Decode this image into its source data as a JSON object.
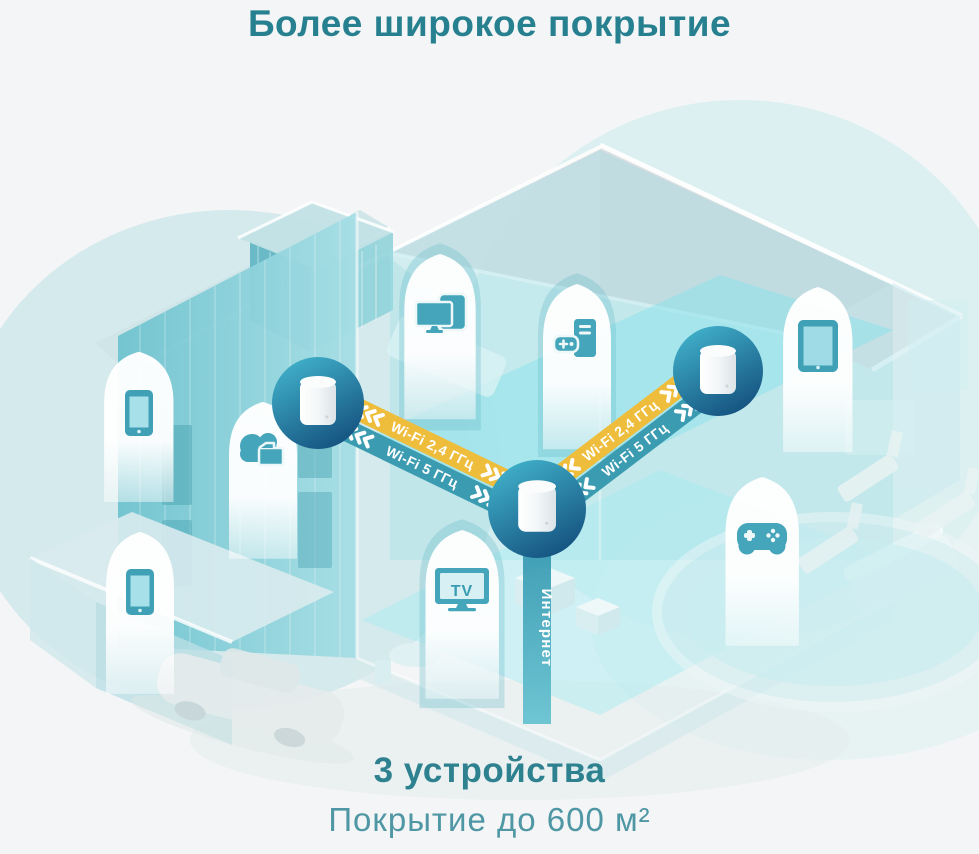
{
  "title": "Более широкое покрытие",
  "footer": {
    "devices_count": "3 устройства",
    "coverage": "Покрытие до 600 м²"
  },
  "network": {
    "internet_label": "Интернет",
    "links": [
      {
        "id": "center-to-left",
        "bands": [
          {
            "label": "Wi-Fi 2,4 ГГц"
          },
          {
            "label": "Wi-Fi 5 ГГц"
          }
        ]
      },
      {
        "id": "center-to-right",
        "bands": [
          {
            "label": "Wi-Fi 2,4 ГГц"
          },
          {
            "label": "Wi-Fi 5 ГГц"
          }
        ]
      }
    ],
    "nodes": [
      {
        "name": "deco-unit-left"
      },
      {
        "name": "deco-unit-center"
      },
      {
        "name": "deco-unit-right"
      }
    ]
  },
  "device_icons": [
    {
      "name": "smartphone"
    },
    {
      "name": "cloud-storage"
    },
    {
      "name": "monitor-and-tablet"
    },
    {
      "name": "gaming-pc"
    },
    {
      "name": "tablet"
    },
    {
      "name": "tv",
      "label": "TV"
    },
    {
      "name": "gamepad"
    },
    {
      "name": "smartphone"
    }
  ],
  "colors": {
    "title_teal": "#27808f",
    "subtitle_teal": "#4f97a4",
    "band_24ghz_yellow": "#eebd3c",
    "band_5ghz_teal": "#3b9cb1",
    "icon_teal": "#45a5ba",
    "badge_gradient_top": "#41b2cb",
    "badge_gradient_bottom": "#14507e",
    "background": "#f3f5f6"
  }
}
